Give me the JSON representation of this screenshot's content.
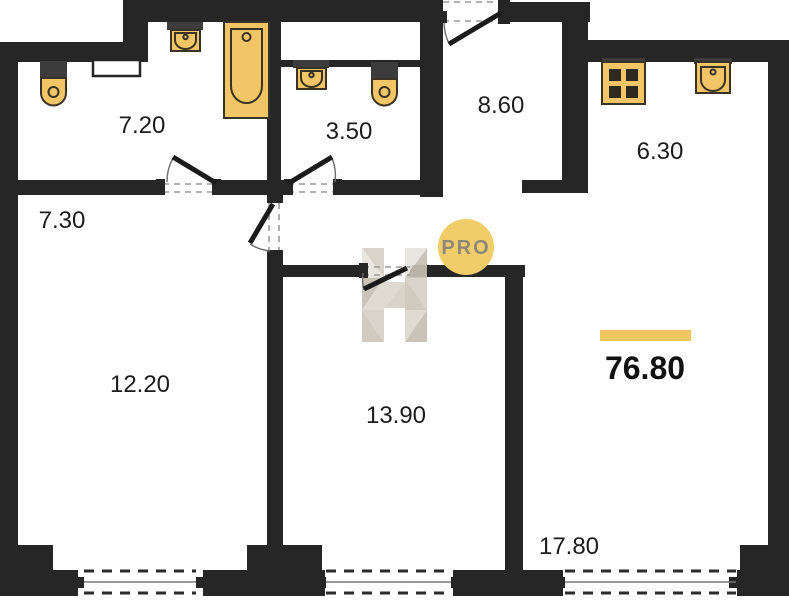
{
  "floor_plan": {
    "title": "apartment-floor-plan",
    "total_area": {
      "value": "76.80",
      "accent_bar_color": "#F0C75E"
    },
    "watermark": {
      "logo_letter": "H",
      "badge_text": "PRO",
      "badge_color": "#F1CD69"
    },
    "rooms": [
      {
        "id": "bathroom-1",
        "area": "7.20"
      },
      {
        "id": "bathroom-2",
        "area": "3.50"
      },
      {
        "id": "hallway",
        "area": "8.60"
      },
      {
        "id": "kitchen",
        "area": "6.30"
      },
      {
        "id": "corridor",
        "area": "7.30"
      },
      {
        "id": "room-1",
        "area": "12.20"
      },
      {
        "id": "room-2",
        "area": "13.90"
      },
      {
        "id": "living-room",
        "area": "17.80"
      }
    ],
    "fixtures": [
      "toilet",
      "sink",
      "bathtub",
      "sink",
      "toilet",
      "stove",
      "kitchen-sink"
    ],
    "colors": {
      "wall": "#262626",
      "fixture_fill": "#F2C566",
      "fixture_stroke": "#3a3325"
    }
  }
}
